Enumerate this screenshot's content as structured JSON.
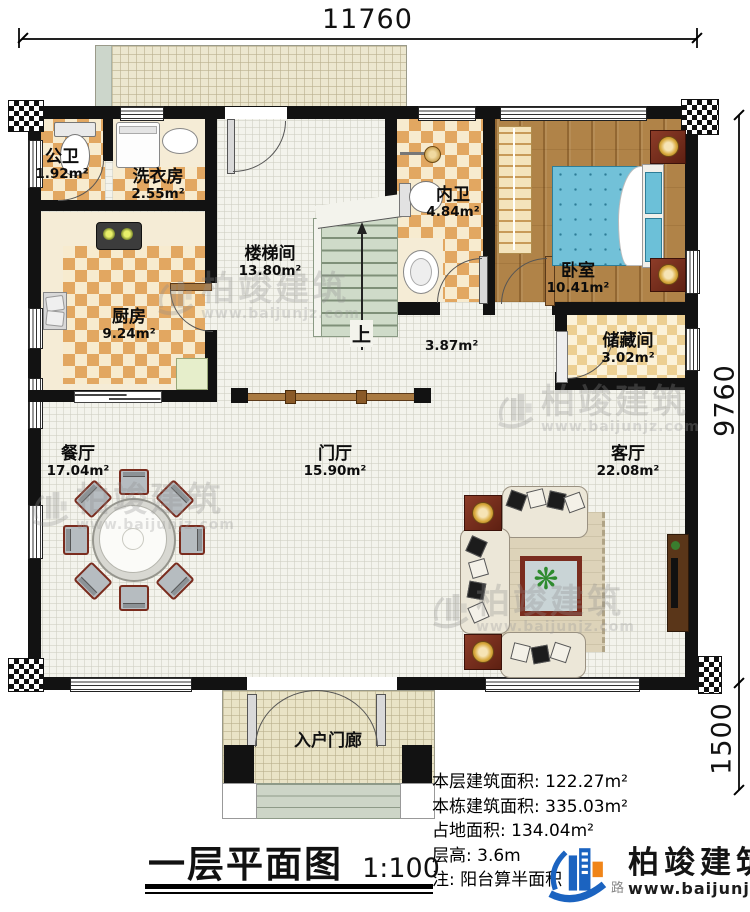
{
  "dimensions": {
    "top": "11760",
    "right_main": "9760",
    "right_porch": "1500"
  },
  "rooms": [
    {
      "name": "公卫",
      "area": "1.92m²"
    },
    {
      "name": "洗衣房",
      "area": "2.55m²"
    },
    {
      "name": "楼梯间",
      "area": "13.80m²"
    },
    {
      "name": "内卫",
      "area": "4.84m²"
    },
    {
      "name": "卧室",
      "area": "10.41m²"
    },
    {
      "name": "厨房",
      "area": "9.24m²"
    },
    {
      "name": "储藏间",
      "area": "3.02m²"
    },
    {
      "name": "餐厅",
      "area": "17.04m²"
    },
    {
      "name": "门厅",
      "area": "15.90m²"
    },
    {
      "name": "客厅",
      "area": "22.08m²"
    },
    {
      "name": "入户门廊",
      "area": ""
    }
  ],
  "extra": {
    "corridor_area": "3.87m²",
    "stairs_up": "上"
  },
  "title": {
    "main": "一层平面图",
    "scale": "1:100"
  },
  "stats": [
    {
      "label": "本层建筑面积: ",
      "value": "122.27m²"
    },
    {
      "label": "本栋建筑面积: ",
      "value": "335.03m²"
    },
    {
      "label": "占地面积: ",
      "value": "134.04m²"
    },
    {
      "label": "层高: ",
      "value": "3.6m"
    },
    {
      "label": "注: ",
      "value": "阳台算半面积"
    }
  ],
  "logo": {
    "name": "柏竣建筑",
    "url": "www.baijunjz.com",
    "stray": "路"
  },
  "watermark": {
    "text": "柏竣建筑",
    "url": "www.baijunjz.com"
  },
  "colors": {
    "wall": "#121212",
    "tile_orange": "#e2a761",
    "bed_blue": "#72c1d8",
    "wood": "#b08348",
    "logo_blue": "#1b63c0",
    "logo_orange": "#f08519"
  }
}
